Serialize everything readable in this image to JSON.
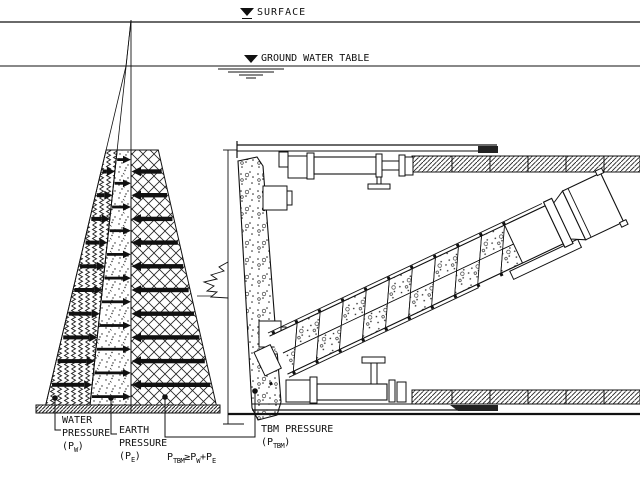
{
  "annotations": {
    "surface": "SURFACE",
    "gwt": "GROUND WATER TABLE"
  },
  "labels": {
    "water": {
      "l1": "WATER",
      "l2": "PRESSURE",
      "p": "(P",
      "sub": "W",
      "q": ")"
    },
    "earth": {
      "l1": "EARTH",
      "l2": "PRESSURE",
      "p": "(P",
      "sub": "E",
      "q": ")"
    },
    "tbm": {
      "l1": "TBM PRESSURE",
      "p": "(P",
      "sub": "TBM",
      "q": ")"
    },
    "formula": {
      "a": "P",
      "asub": "TBM",
      "op": "≥",
      "b": "P",
      "bsub": "W",
      "plus": "+",
      "c": "P",
      "csub": "E"
    }
  },
  "regions": [
    {
      "name": "water-pressure",
      "pattern": "zigzag-hatch",
      "arrow_direction": "right"
    },
    {
      "name": "earth-pressure",
      "pattern": "sand-dots",
      "arrow_direction": "right"
    },
    {
      "name": "tbm-pressure",
      "pattern": "diamond-crosshatch",
      "arrow_direction": "left"
    }
  ],
  "colors": {
    "ink": "#111111",
    "paper": "#ffffff"
  }
}
